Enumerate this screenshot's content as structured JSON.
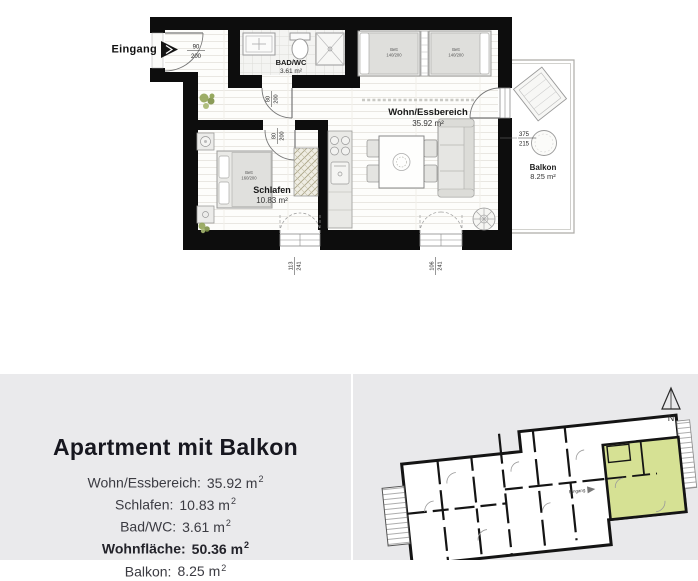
{
  "plan": {
    "entrance": {
      "label": "Eingang"
    },
    "rooms": {
      "bad": {
        "name": "BAD/WC",
        "area": "3.61 m²"
      },
      "wohn": {
        "name": "Wohn/Essbereich",
        "area": "35.92 m²"
      },
      "schlafen": {
        "name": "Schlafen",
        "area": "10.83 m²"
      },
      "balkon": {
        "name": "Balkon",
        "area": "8.25 m²"
      }
    },
    "doors": {
      "entry": {
        "w": "90",
        "h": "200"
      },
      "bad": {
        "w": "80",
        "h": "200"
      },
      "schlafen": {
        "w": "80",
        "h": "200"
      }
    },
    "windows": {
      "left": {
        "w": "113",
        "h": "241"
      },
      "right": {
        "w": "106",
        "h": "241"
      },
      "balcony": {
        "w": "375",
        "h": "215"
      }
    },
    "furniture": {
      "bett1": {
        "name": "Bett",
        "size": "140/200"
      },
      "bett2": {
        "name": "Bett",
        "size": "140/200"
      },
      "bett3": {
        "name": "Bett",
        "size": "160/200"
      }
    }
  },
  "info_panel": {
    "title": "Apartment mit Balkon",
    "rows": [
      {
        "label": "Wohn/Essbereich:",
        "value": "35.92 m",
        "sup": "2"
      },
      {
        "label": "Schlafen:",
        "value": "10.83 m",
        "sup": "2"
      },
      {
        "label": "Bad/WC:",
        "value": "3.61 m",
        "sup": "2"
      },
      {
        "label": "Wohnfläche:",
        "value": "50.36 m",
        "sup": "2"
      },
      {
        "label": "Balkon:",
        "value": "8.25 m",
        "sup": "2"
      }
    ]
  },
  "overview": {
    "north_label": "N",
    "entrance_label": "Eingang",
    "highlight_color": "#d6e194"
  }
}
